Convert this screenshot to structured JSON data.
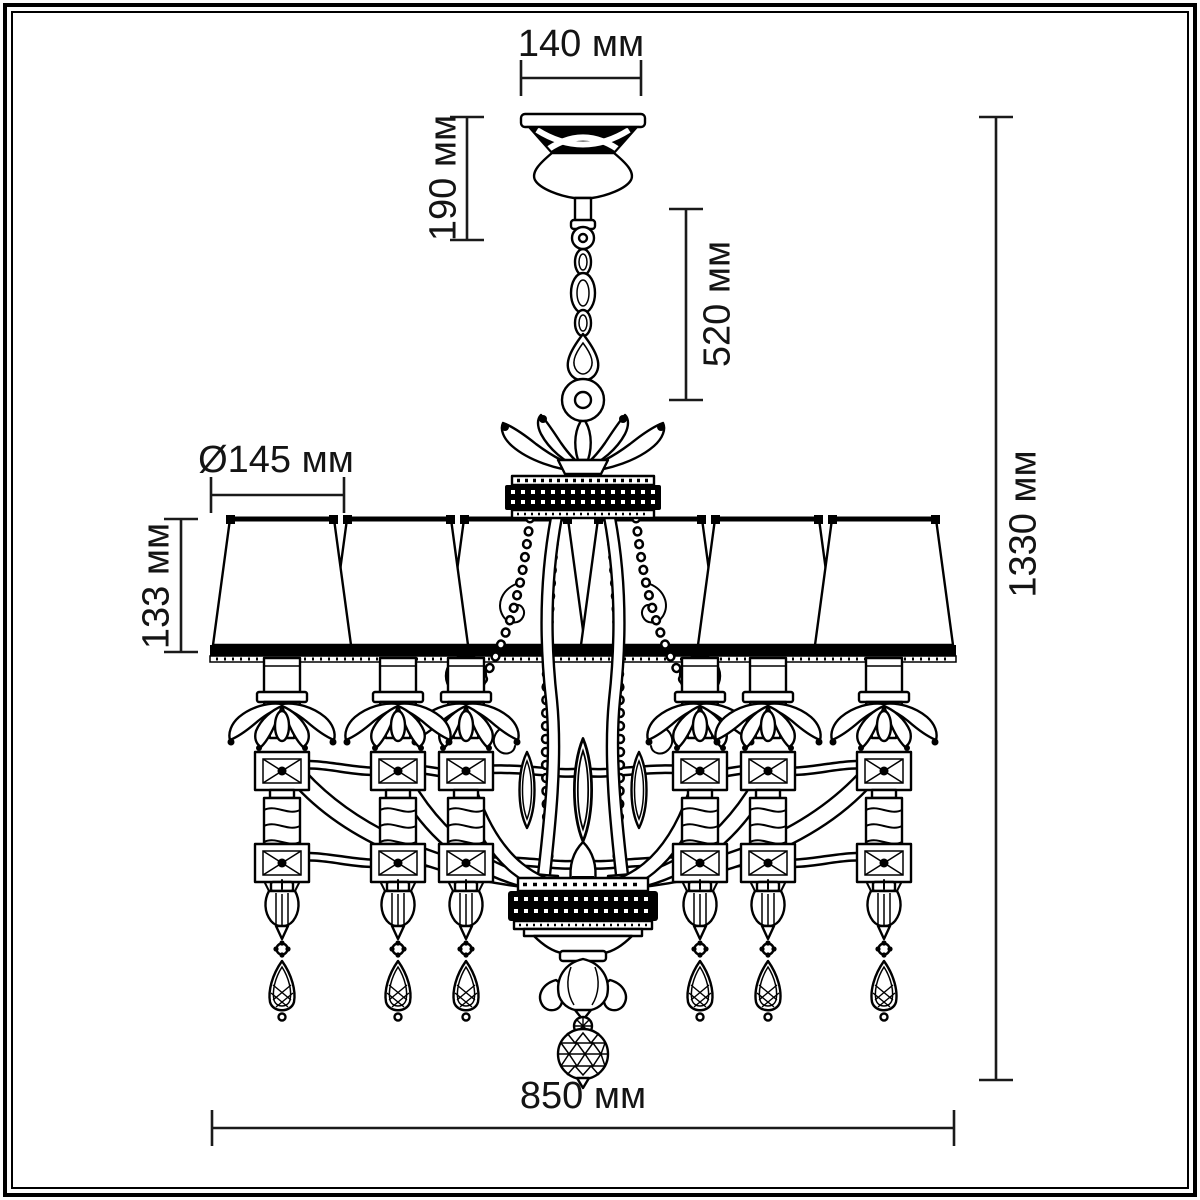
{
  "drawing": {
    "subject": "chandelier technical dimension drawing",
    "units": "мм",
    "background_color": "#ffffff",
    "ink_color": "#000000",
    "dimension_color": "#1a1a1a",
    "lights_count": 6
  },
  "dimensions": {
    "canopy_width": "140 мм",
    "canopy_height": "190 мм",
    "chain_drop": "520 мм",
    "shade_diameter": "Ø145 мм",
    "shade_height": "133 мм",
    "overall_height": "1330 мм",
    "overall_width": "850 мм"
  },
  "dimension_values": {
    "canopy_width_mm": 140,
    "canopy_height_mm": 190,
    "chain_drop_mm": 520,
    "shade_diameter_mm": 145,
    "shade_height_mm": 133,
    "overall_height_mm": 1330,
    "overall_width_mm": 850
  }
}
